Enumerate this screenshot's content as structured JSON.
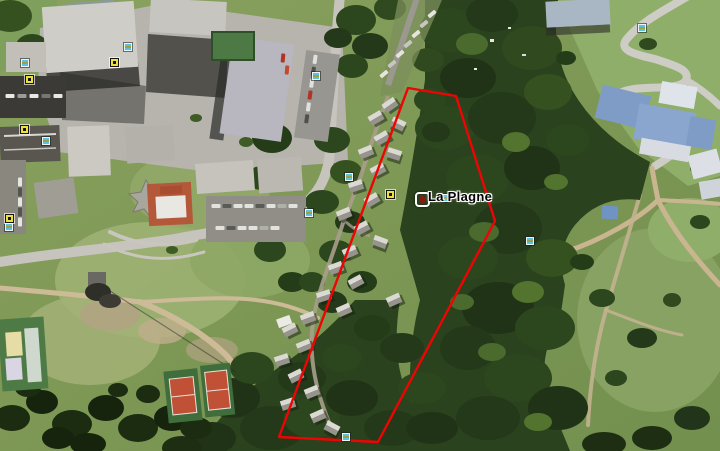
{
  "viewport": {
    "width": 720,
    "height": 451
  },
  "map_overlay": {
    "placemark": {
      "label": "La Plagne",
      "x": 423,
      "y": 200,
      "dot_color": "#8d1812",
      "frame_color": "#ffffff"
    },
    "boundary_polygon": {
      "color": "#ee0404",
      "stroke_width": 2.4,
      "points": [
        [
          408,
          88
        ],
        [
          456,
          96
        ],
        [
          495,
          221
        ],
        [
          378,
          442
        ],
        [
          279,
          437
        ]
      ]
    },
    "poi_icons": {
      "photo_icon_color": "#56c3e6",
      "lodging_icon_color": "#efe13c",
      "photo": [
        [
          25,
          63
        ],
        [
          128,
          47
        ],
        [
          46,
          141
        ],
        [
          9,
          227
        ],
        [
          316,
          76
        ],
        [
          642,
          28
        ],
        [
          349,
          177
        ],
        [
          309,
          213
        ],
        [
          445,
          198
        ],
        [
          530,
          241
        ],
        [
          346,
          437
        ]
      ],
      "lodging": [
        [
          29,
          79
        ],
        [
          114,
          62
        ],
        [
          24,
          129
        ],
        [
          9,
          218
        ],
        [
          390,
          194
        ]
      ]
    }
  },
  "scene": {
    "type": "aerial-satellite-photo",
    "visible_features": [
      "ski resort buildings",
      "red-roof star building",
      "parking lots with cars",
      "chalet village on wooded slope",
      "conifer forest",
      "two tennis courts",
      "sports field",
      "winding hairpin road",
      "dirt trails",
      "alpine meadow",
      "blue-roof buildings"
    ]
  }
}
